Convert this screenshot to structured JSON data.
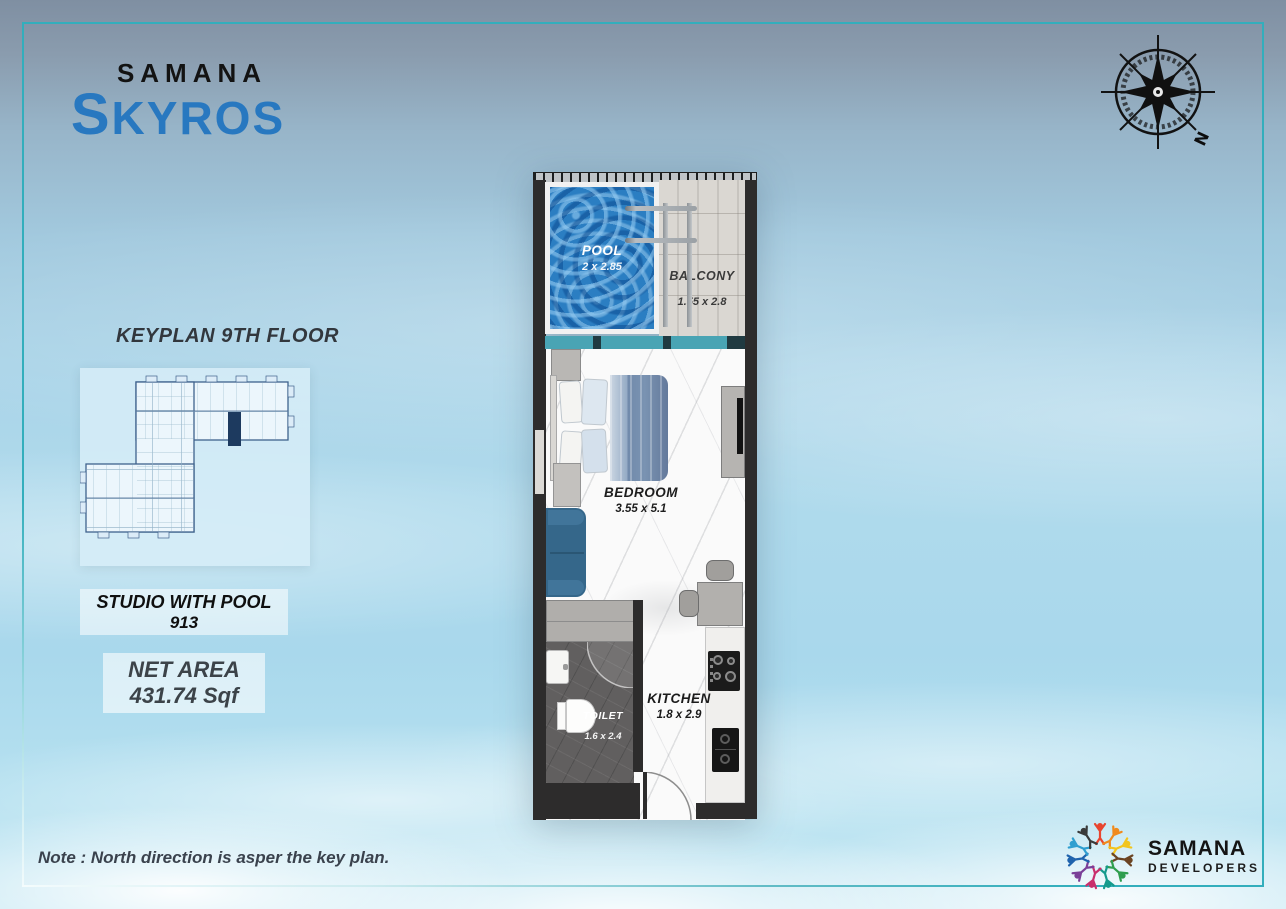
{
  "brand": {
    "name": "SAMANA",
    "product": "SKYROS"
  },
  "compass": {
    "north": "N"
  },
  "keyplan": {
    "title": "KEYPLAN 9TH FLOOR"
  },
  "unit": {
    "type": "STUDIO WITH POOL",
    "number": "913",
    "net_area_label": "NET AREA",
    "net_area_value": "431.74 Sqf"
  },
  "rooms": {
    "pool": {
      "name": "POOL",
      "dims": "2  x 2.85"
    },
    "balcony": {
      "name": "BALCONY",
      "dims": "1.55  x 2.8"
    },
    "bedroom": {
      "name": "BEDROOM",
      "dims": "3.55  x 5.1"
    },
    "kitchen": {
      "name": "KITCHEN",
      "dims": "1.8 x 2.9"
    },
    "toilet": {
      "name": "TOILET",
      "dims": "1.6 x 2.4"
    }
  },
  "note": {
    "text": "Note : North direction is asper the key plan."
  },
  "developer": {
    "name": "SAMANA",
    "tagline": "DEVELOPERS"
  },
  "colors": {
    "accent_teal": "#33aebc",
    "logo_blue": "#2878c0",
    "pool_blue": "#2b7ec2",
    "keyplan_highlight": "#1d3a5f",
    "wall_dark": "#2d2c2c"
  }
}
